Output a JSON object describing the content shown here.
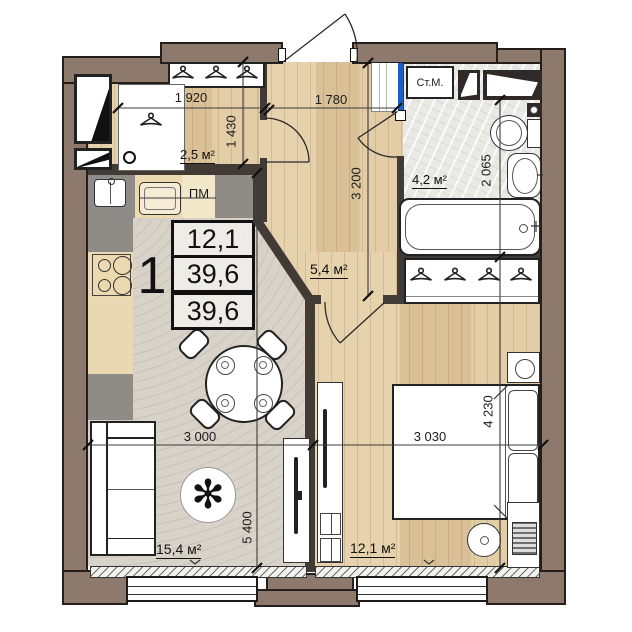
{
  "title": "1-room apartment floor plan",
  "info_box": {
    "room_count": "1",
    "values": [
      "12,1",
      "39,6",
      "39,6"
    ]
  },
  "rooms": {
    "hallway": {
      "area": "2,5 м²"
    },
    "corridor": {
      "area": "5,4 м²"
    },
    "bathroom": {
      "area": "4,2 м²",
      "washer": "Ст.М.",
      "bath_length": "1 840"
    },
    "living_kitchen": {
      "area": "15,4 м²",
      "dishwasher": "ПМ"
    },
    "bedroom": {
      "area": "12,1 м²"
    }
  },
  "dimensions": {
    "hall_width": "1 920",
    "corridor_width": "1 780",
    "hall_depth": "1 430",
    "corridor_length": "3 200",
    "bath_depth": "2 065",
    "living_width": "3 000",
    "living_length": "5 400",
    "bedroom_width": "3 030",
    "bedroom_length": "4 230"
  },
  "colors": {
    "wall": "#8d7a6c",
    "interior_wall": "#423a35",
    "wood_floor": "#dfc9a3",
    "carpet": "#d8d2c8",
    "tile": "#e9e9e6",
    "accent_blue": "#1d5fc4"
  }
}
